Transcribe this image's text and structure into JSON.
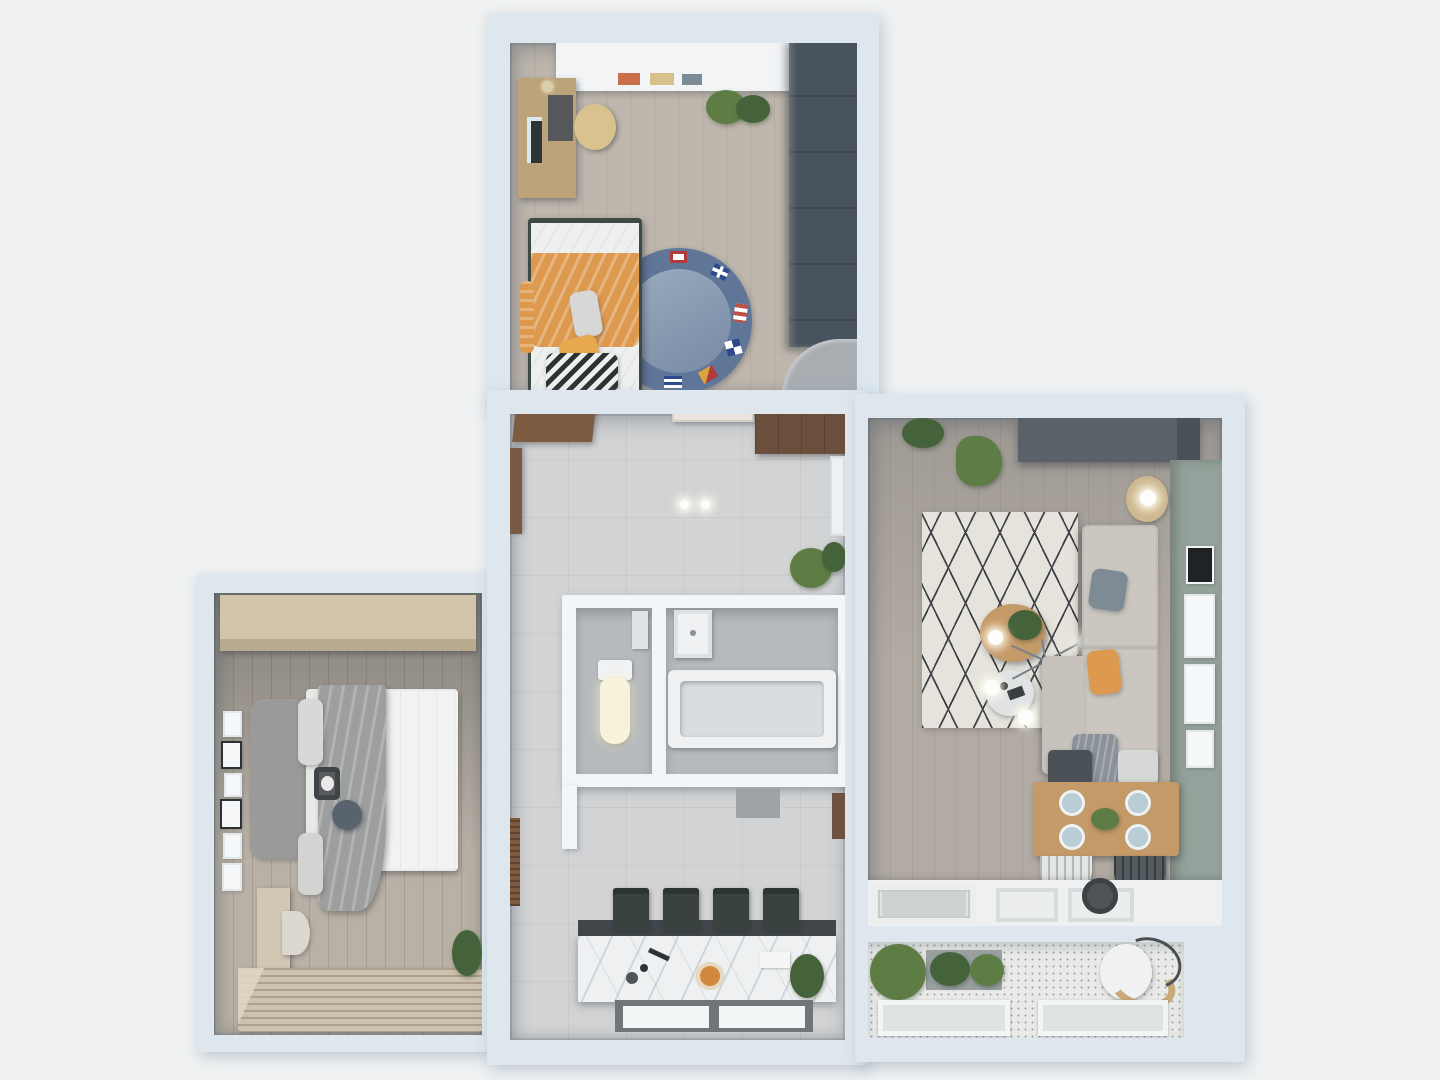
{
  "scene": {
    "description": "3D rendered top-down floor plan of a two-bedroom apartment, no visible text",
    "palette": {
      "background": "#eff1f2",
      "wall": "#dee7ee",
      "wall_inner": "#f3f6f8",
      "kids_floor": "#bfb7ad",
      "hall_floor": "#d2d3d4",
      "bath_floor": "#b7babc",
      "bedroom_floor": "#b9b1a6",
      "living_floor": "#b2aba3",
      "balcony_floor": "#e9eae8",
      "marble_island": "#eef0f1",
      "island_edge": "#41464a",
      "stool_green": "#39423e",
      "accent_orange": "#dd9a4f",
      "rug_blue": "#7e93ad",
      "rug_blue_rim": "#5f7699",
      "rug_living": "#e6e3dc",
      "rug_stripe_base": "#cdc2af",
      "sofa_beige": "#cbc7c0",
      "cushion_gray": "#7e8b95",
      "blanket_gray": "#9d9e9e",
      "green_wall": "#94a29b",
      "tv_unit_dark": "#5a6168",
      "wardrobe_dark": "#49535d",
      "wardrobe_tan": "#d3c5ac",
      "dresser_wood": "#d2c7b2",
      "desk_wood": "#bda379",
      "table_wood": "#c59a69",
      "bench_wood": "#7d5c42",
      "hall_wardrobe_wood": "#6b4f3d",
      "white_furniture": "#f2f4f6",
      "window_frame": "#70757a",
      "plant_green": "#5d7d45",
      "plant_dark_green": "#44633a",
      "plate_blue": "#b9cdd7"
    },
    "rooms": [
      {
        "name": "kids-bedroom",
        "position": "top-center",
        "furniture": [
          "wall-shelf",
          "desk",
          "monitor",
          "desk-chair",
          "single-bed",
          "orange-blanket",
          "chevron-pillow",
          "nautical-round-rug",
          "dark-wardrobe",
          "corner-desk",
          "potted-plant"
        ]
      },
      {
        "name": "hallway",
        "position": "center",
        "furniture": [
          "shoe-bench",
          "entry-door",
          "hall-wardrobe",
          "wall-cabinet",
          "ceiling-lights",
          "plant"
        ]
      },
      {
        "name": "bathroom",
        "position": "center-middle",
        "furniture": [
          "toilet",
          "boiler",
          "sink",
          "bathtub"
        ]
      },
      {
        "name": "kitchen",
        "position": "center-bottom",
        "furniture": [
          "marble-island",
          "bar-stools",
          "pizza-plate",
          "plant",
          "window"
        ]
      },
      {
        "name": "master-bedroom",
        "position": "left",
        "furniture": [
          "tan-wardrobe",
          "double-bed",
          "gray-blanket",
          "panda-pillow",
          "picture-frames",
          "dresser",
          "chair",
          "striped-rug",
          "plant"
        ]
      },
      {
        "name": "living-room",
        "position": "right",
        "furniture": [
          "tv-unit",
          "diamond-rug",
          "l-shaped-sofa",
          "coffee-table",
          "side-table",
          "chandelier",
          "floor-lamp",
          "green-accent-wall",
          "picture-frames",
          "dining-table",
          "plates",
          "dining-chairs",
          "kitchen-counter",
          "sink"
        ]
      },
      {
        "name": "balcony",
        "position": "bottom-right",
        "furniture": [
          "herb-planters",
          "bucket",
          "windows"
        ]
      }
    ]
  }
}
